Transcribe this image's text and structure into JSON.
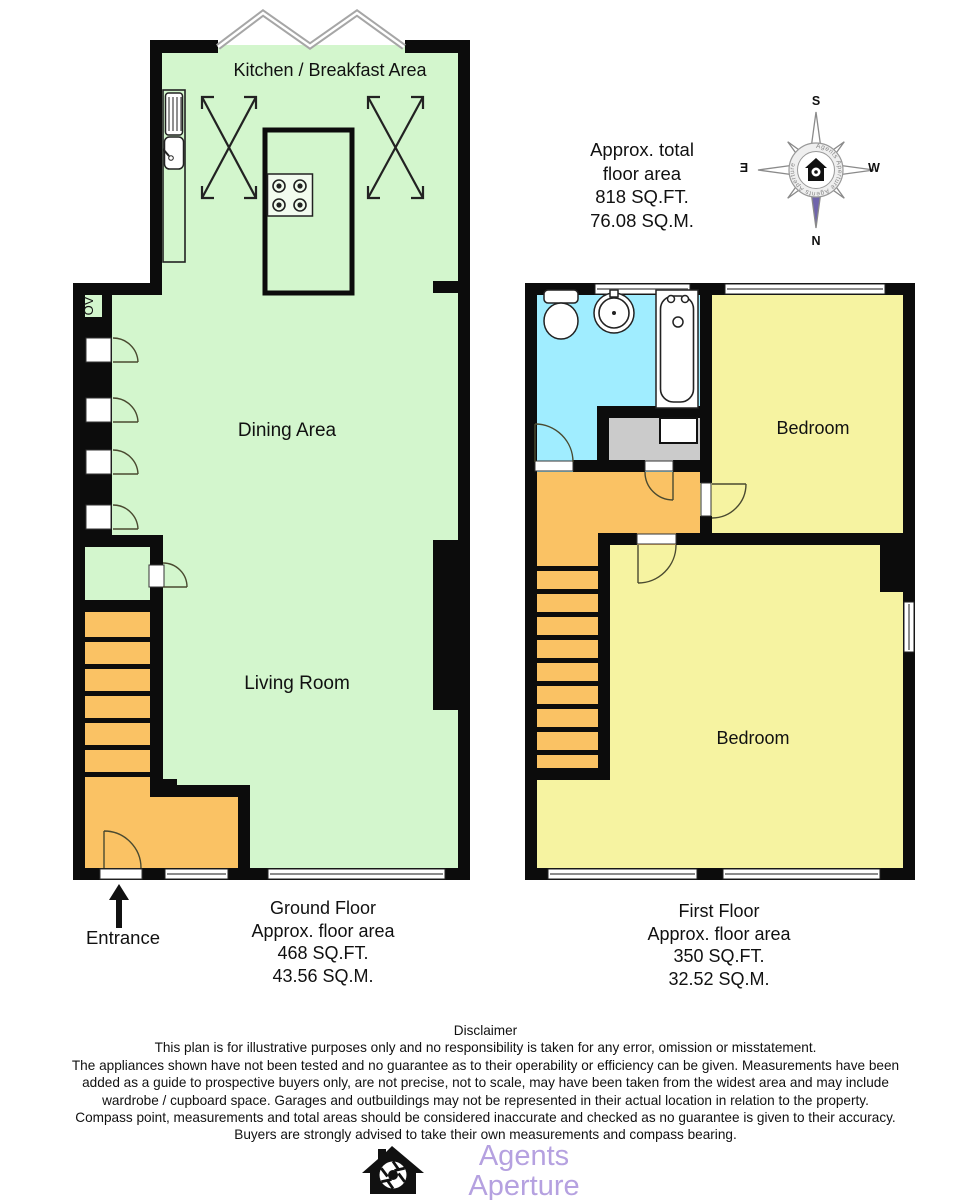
{
  "plan": {
    "ground_floor": {
      "rooms": {
        "kitchen": "Kitchen / Breakfast Area",
        "dining": "Dining Area",
        "living": "Living Room",
        "oven": "OV"
      },
      "caption": {
        "title": "Ground Floor",
        "subtitle": "Approx. floor area",
        "sqft": "468 SQ.FT.",
        "sqm": "43.56 SQ.M."
      },
      "entrance_label": "Entrance"
    },
    "first_floor": {
      "rooms": {
        "bedroom_front": "Bedroom",
        "bedroom_back": "Bedroom"
      },
      "caption": {
        "title": "First Floor",
        "subtitle": "Approx. floor area",
        "sqft": "350 SQ.FT.",
        "sqm": "32.52 SQ.M."
      }
    },
    "total_area": {
      "line1": "Approx. total",
      "line2": "floor area",
      "sqft": "818 SQ.FT.",
      "sqm": "76.08 SQ.M."
    }
  },
  "compass": {
    "north": "N",
    "south": "S",
    "east": "E",
    "west": "W",
    "ring_text": "Agents Aperture  Agents Aperture"
  },
  "disclaimer": {
    "title": "Disclaimer",
    "lines": [
      "This plan is for illustrative purposes only and no responsibility is taken for any error, omission or misstatement.",
      "The appliances shown have not been tested and no guarantee as to their operability or efficiency can be given. Measurements have been",
      "added as a guide to prospective buyers only, are not precise, not to scale, may have been taken from the widest area and may include",
      "wardrobe / cupboard space. Garages and outbuildings may not be represented in their actual location in relation to the property.",
      "Compass point, measurements and total areas should be considered inaccurate and checked as no guarantee is given to their accuracy.",
      "Buyers are strongly advised to take their own measurements and compass bearing."
    ]
  },
  "footer": {
    "brand": "Agents Aperture",
    "website": "agentsaperture.co.uk"
  },
  "colors": {
    "wall": "#0c0c0c",
    "room_green": "#d3f6cd",
    "room_yellow": "#f6f3a1",
    "room_orange": "#fac264",
    "room_cyan": "#a0edff",
    "storage_gray": "#cbcbcb",
    "window_line": "#8c8c8c",
    "bay_gray": "#a6a6a6",
    "compass_purple": "#6f64ab",
    "brand_purple": "#b5a1e0",
    "text": "#111111"
  }
}
